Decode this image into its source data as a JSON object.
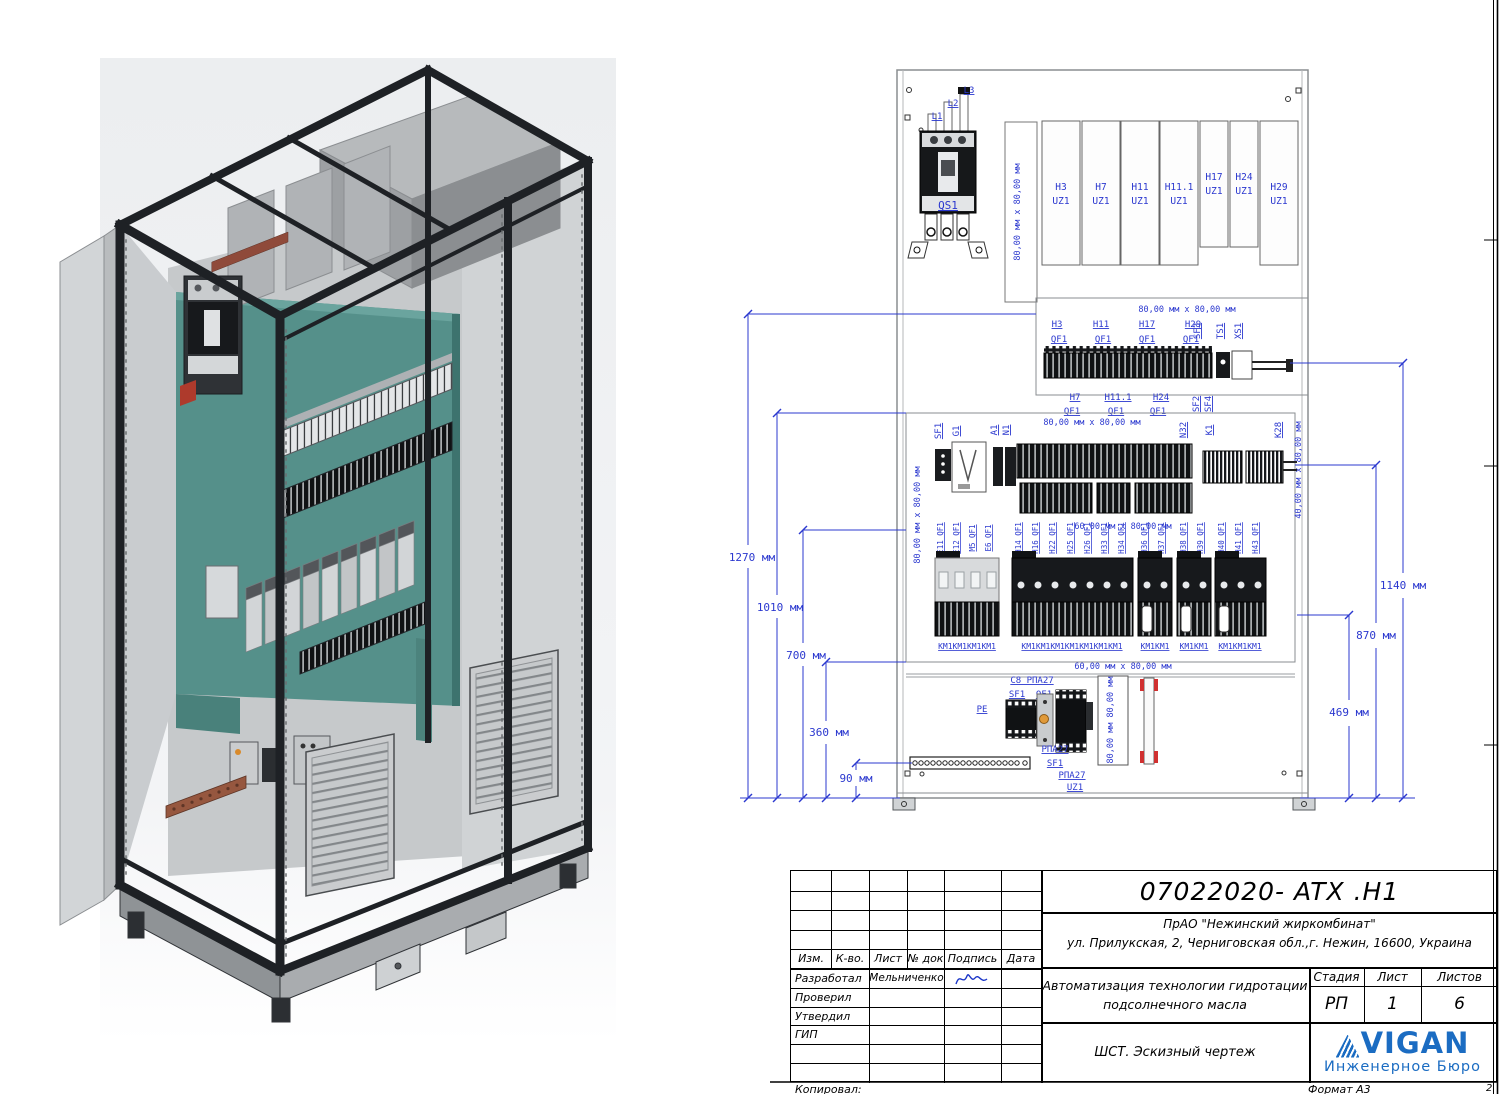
{
  "page": {
    "copied": "Копировал:",
    "format": "Формат А3",
    "sheet_corner": "2"
  },
  "colors": {
    "annotation_blue": "#2b38cf",
    "teal_panel": "#55908a",
    "logo_blue": "#1b6cc2"
  },
  "drawing": {
    "phases": [
      "L1",
      "L2",
      "L3"
    ],
    "main_switch": "QS1",
    "duct_80": "80,00 мм x 80,00 мм",
    "duct_60": "60,00 мм x 80,00 мм",
    "duct_40": "40,00 мм x 80,00 мм",
    "duct_80b": "80,00 мм 80,00 мм",
    "modules": [
      {
        "id": "H3",
        "unit": "UZ1"
      },
      {
        "id": "H7",
        "unit": "UZ1"
      },
      {
        "id": "H11",
        "unit": "UZ1"
      },
      {
        "id": "H11.1",
        "unit": "UZ1"
      },
      {
        "id": "H17",
        "unit": "UZ1"
      },
      {
        "id": "H24",
        "unit": "UZ1"
      },
      {
        "id": "H29",
        "unit": "UZ1"
      }
    ],
    "rail1_top_ids": [
      "H3",
      "H11",
      "H17",
      "H29"
    ],
    "rail1_top_dev": [
      "QF1",
      "QF1",
      "QF1",
      "QF1"
    ],
    "rail1_side_top": [
      "SF3",
      "TS1",
      "XS1"
    ],
    "rail1_bottom_ids": [
      "H7",
      "H11.1",
      "H24"
    ],
    "rail1_bottom_dev": [
      "QF1",
      "QF1",
      "QF1"
    ],
    "rail1_side_bottom": [
      "SF2",
      "SF4"
    ],
    "rail2_labels": [
      "SF1",
      "G1",
      "A1",
      "N1",
      "N32",
      "K1",
      "K28"
    ],
    "rail3_units": [
      "E11 QF1",
      "E12 QF1",
      "M5 QF1",
      "E6 QF1",
      "H14 QF1",
      "H16 QF1",
      "H22 QF1",
      "H25 QF1",
      "H26 QF1",
      "H33 QF1",
      "H34 QF1",
      "H36 QF1",
      "H37 QF1",
      "H38 QF1",
      "H39 QF1",
      "H40 QF1",
      "H41 QF1",
      "H43 QF1"
    ],
    "rail3_km": [
      "КМ1КМ1КМ1КМ1",
      "КМ1КМ1КМ1КМ1КМ1КМ1КМ1",
      "КМ1КМ1",
      "КМ1КМ1",
      "КМ1КМ1КМ1"
    ],
    "bottom_labels": {
      "c8": "C8 РПА27",
      "sf1a": "SF1",
      "qf1": "QF1",
      "pe": "PE",
      "rpa1": "РПА27",
      "sf1b": "SF1",
      "rpa2": "РПА27",
      "uz1": "UZ1"
    },
    "dims_left": [
      "1270 мм",
      "1010 мм",
      "700 мм",
      "360 мм",
      "90 мм"
    ],
    "dims_right": [
      "1140 мм",
      "870 мм",
      "469 мм"
    ]
  },
  "title_block": {
    "doc_number": "07022020- ATX .H1",
    "client_line1": "ПрАО \"Нежинский жиркомбинат\"",
    "client_line2": "ул. Прилукская, 2, Черниговская обл.,г. Нежин, 16600, Украина",
    "project_line1": "Автоматизация технологии гидротации",
    "project_line2": "подсолнечного масла",
    "doc_type": "ШСТ. Эскизный чертеж",
    "stage_label": "Стадия",
    "sheet_label": "Лист",
    "sheets_label": "Листов",
    "stage": "РП",
    "sheet": "1",
    "sheets": "6",
    "cols": [
      "Изм.",
      "К-во.",
      "Лист",
      "№ док",
      "Подпись",
      "Дата"
    ],
    "rows": [
      "Разработал",
      "Проверил",
      "Утвердил",
      "ГИП"
    ],
    "developer": "Мельниченко",
    "logo_text": "VIGAN",
    "logo_sub": "Инженерное Бюро"
  }
}
